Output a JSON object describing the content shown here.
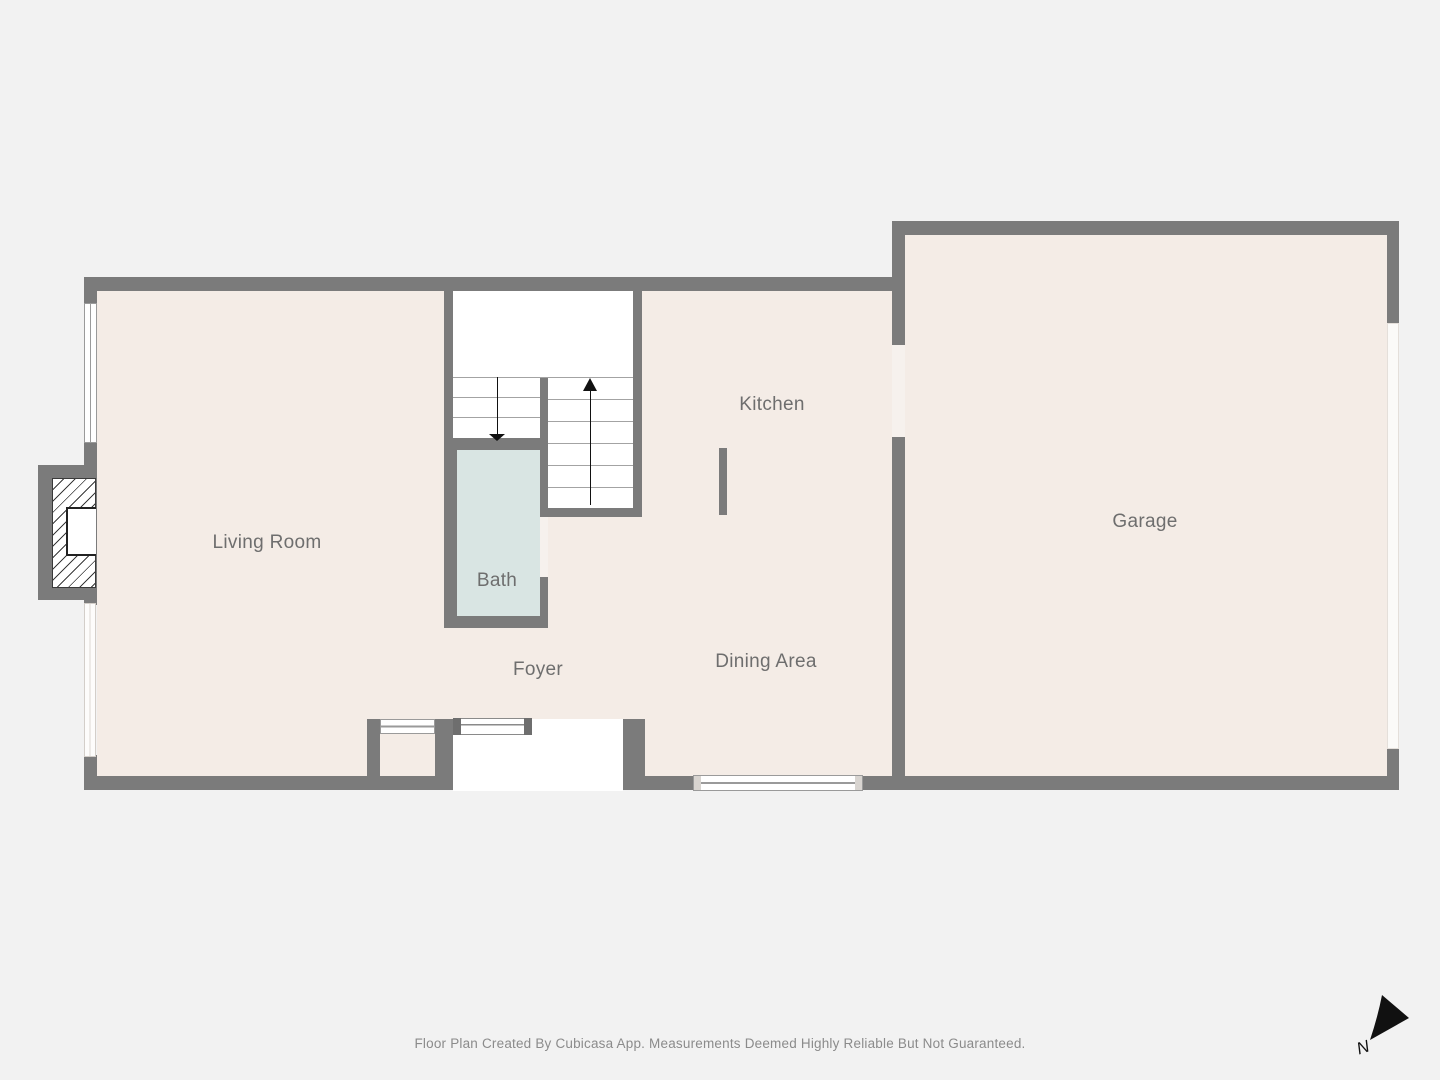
{
  "floorplan": {
    "rooms": {
      "living_room": {
        "label": "Living Room"
      },
      "bath": {
        "label": "Bath"
      },
      "foyer": {
        "label": "Foyer"
      },
      "kitchen": {
        "label": "Kitchen"
      },
      "dining_area": {
        "label": "Dining Area"
      },
      "garage": {
        "label": "Garage"
      }
    },
    "compass": {
      "north_label": "N"
    },
    "footer": {
      "disclaimer": "Floor Plan Created By Cubicasa App. Measurements Deemed Highly Reliable But Not Guaranteed."
    },
    "colors": {
      "background": "#f2f2f2",
      "floor": "#f4ece6",
      "wall": "#7b7b7b",
      "bath_floor": "#d9e5e3",
      "label_text": "#6e6e6e",
      "footer_text": "#8b8b8b",
      "stair_line": "#a3a3a3"
    }
  }
}
